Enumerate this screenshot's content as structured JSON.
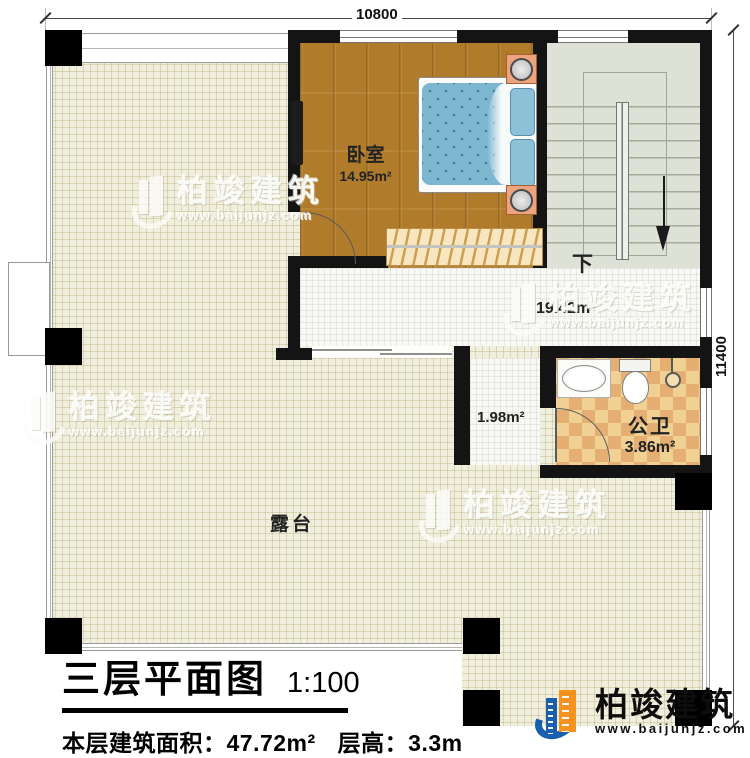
{
  "dimensions": {
    "top_width": "10800",
    "right_height": "11400"
  },
  "rooms": {
    "bedroom": {
      "label": "卧室",
      "area": "14.95m²"
    },
    "hallway": {
      "area": "19.42m²"
    },
    "corridor": {
      "area": "1.98m²"
    },
    "bathroom": {
      "label": "公卫",
      "area": "3.86m²"
    },
    "terrace": {
      "label": "露台"
    },
    "stairs": {
      "direction_label": "下"
    }
  },
  "title_block": {
    "title": "三层平面图",
    "scale": "1:100",
    "area_text": "本层建筑面积：47.72m²",
    "height_text": "层高：3.3m"
  },
  "brand": {
    "name": "柏竣建筑",
    "url": "www.baijunjz.com"
  },
  "colors": {
    "wall": "#141414",
    "wood_floor": "#b07c2c",
    "terrace_floor": "#f0eedd",
    "bath_tile_a": "#f0d093",
    "bath_tile_b": "#e5af74",
    "logo_blue": "#1a5fae",
    "logo_orange": "#f6921e"
  }
}
